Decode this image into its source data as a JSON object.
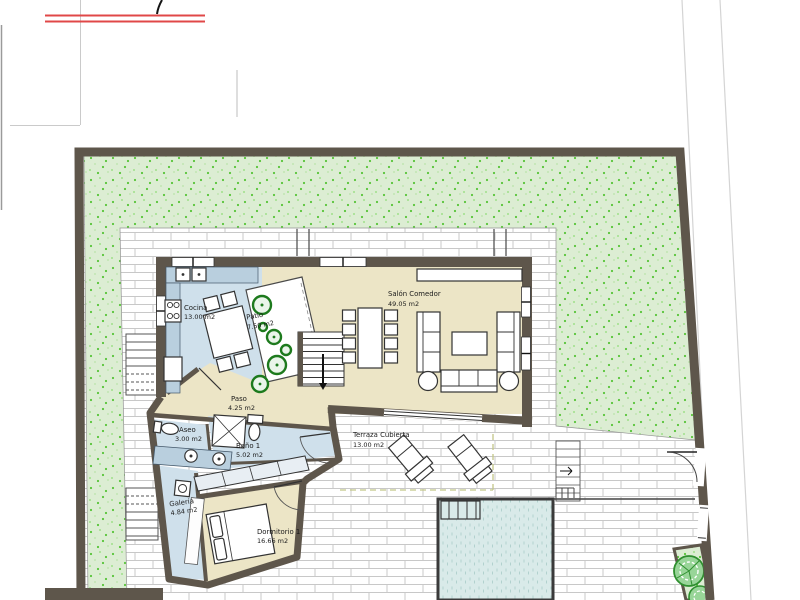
{
  "plan": {
    "rooms": {
      "cocina": {
        "name": "Cocina",
        "area": "13.00 m2"
      },
      "patio": {
        "name": "Patio",
        "area": "7.50 m2"
      },
      "salon_comedor": {
        "name": "Salón Comedor",
        "area": "49.05 m2"
      },
      "paso": {
        "name": "Paso",
        "area": "4.25 m2"
      },
      "aseo": {
        "name": "Aseo",
        "area": "3.00 m2"
      },
      "bano_1": {
        "name": "Baño 1",
        "area": "5.02 m2"
      },
      "galeria": {
        "name": "Galería",
        "area": "4.84 m2"
      },
      "dormitorio_1": {
        "name": "Dormitorio 1",
        "area": "16.66 m2"
      },
      "terraza_cubierta": {
        "name": "Terraza Cubierta",
        "area": "13.00 m2"
      }
    },
    "colors": {
      "wall": "#5e564b",
      "room_dry": "#ece5c6",
      "room_wet": "#cfe0eb",
      "counter": "#b9cfde",
      "garden_base": "#dcedd3",
      "garden_dot": "#57c438",
      "pool": "#d9eae9",
      "plant_green": "#1d7a1d",
      "tree_green": "#98d598",
      "dashed_line": "#c2c689",
      "header_red": "#e04848",
      "brick_line": "#c8c8c8"
    }
  }
}
